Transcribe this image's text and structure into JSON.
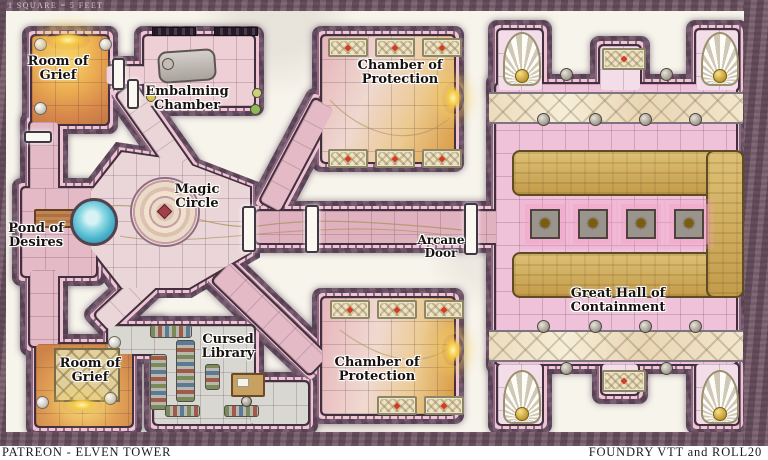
{
  "labels": {
    "scale_note": "1 SQUARE = 5 FEET",
    "room_of_grief_top": {
      "line1": "Room of",
      "line2": "Grief"
    },
    "embalming_chamber": {
      "line1": "Embalming",
      "line2": "Chamber"
    },
    "chamber_of_protection_top": {
      "line1": "Chamber of",
      "line2": "Protection"
    },
    "magic_circle": {
      "line1": "Magic",
      "line2": "Circle"
    },
    "pond_of_desires": {
      "line1": "Pond of",
      "line2": "Desires"
    },
    "arcane_door": {
      "line1": "Arcane",
      "line2": "Door"
    },
    "great_hall": {
      "line1": "Great Hall of",
      "line2": "Containment"
    },
    "cursed_library": {
      "line1": "Cursed",
      "line2": "Library"
    },
    "room_of_grief_bottom": {
      "line1": "Room of",
      "line2": "Grief"
    },
    "chamber_of_protection_bottom": {
      "line1": "Chamber of",
      "line2": "Protection"
    }
  },
  "footer": {
    "left": "PATREON - ELVEN TOWER",
    "right": "FOUNDRY VTT and ROLL20"
  },
  "icons": {
    "rune_star": "✹"
  },
  "colors": {
    "wall": "#6b5366",
    "wall_trim": "#f0c3d4",
    "floor_pink": "#e3bac6",
    "floor_orange": "#ecae52",
    "gold_dais": "#cfae5e",
    "pond_blue": "#49b3cc",
    "glow_gold": "#f3c943"
  }
}
